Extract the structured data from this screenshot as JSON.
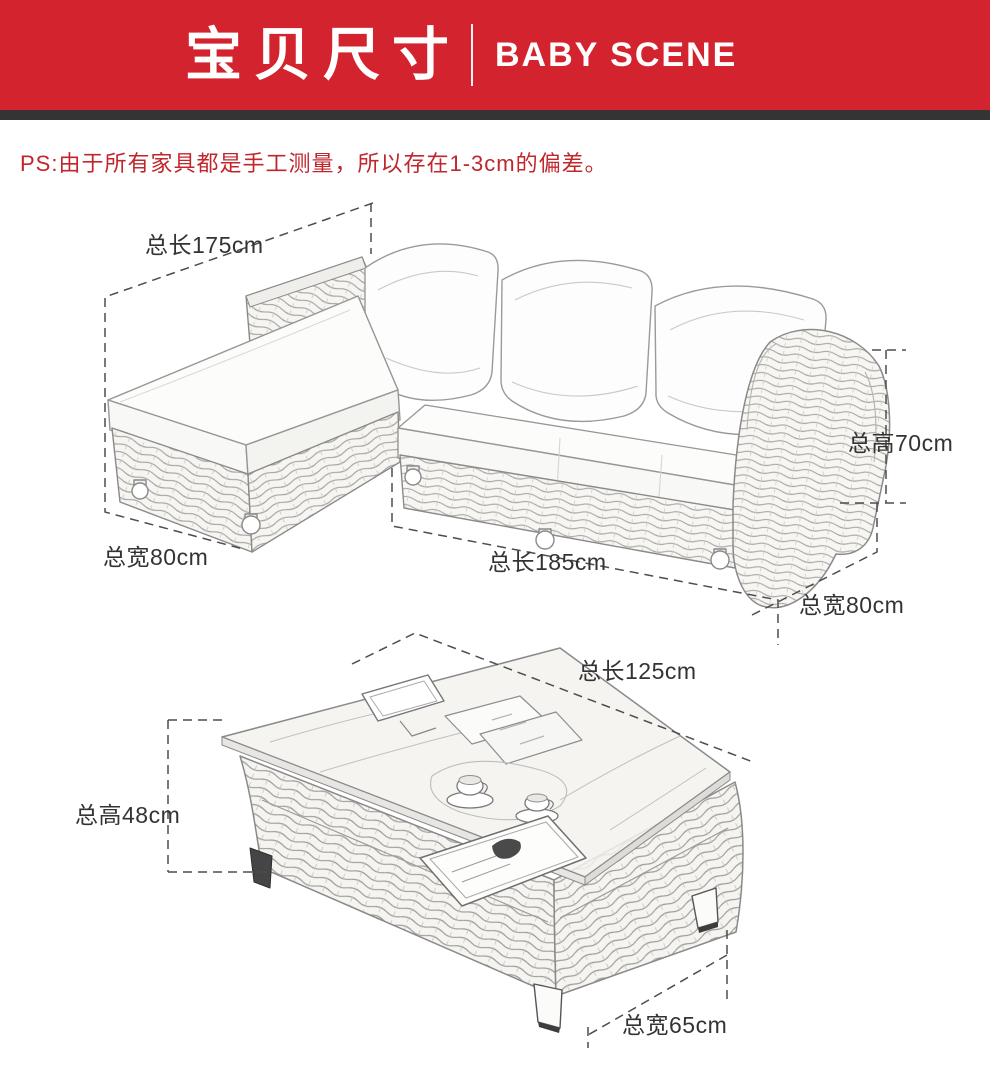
{
  "header": {
    "title": "宝贝尺寸",
    "subtitle": "BABY SCENE",
    "banner_color": "#d2232e",
    "strip_color": "#343336"
  },
  "note": {
    "text": "PS:由于所有家具都是手工测量，所以存在1-3cm的偏差。",
    "color": "#c0262c"
  },
  "sofa": {
    "name": "L形藤编沙发",
    "dimensions": {
      "chaise_length": "总长175cm",
      "chaise_width": "总宽80cm",
      "sofa_length": "总长185cm",
      "sofa_height": "总高70cm",
      "sofa_depth": "总宽80cm"
    }
  },
  "coffee_table": {
    "name": "藤编茶几",
    "dimensions": {
      "length": "总长125cm",
      "height": "总高48cm",
      "width": "总宽65cm"
    }
  }
}
